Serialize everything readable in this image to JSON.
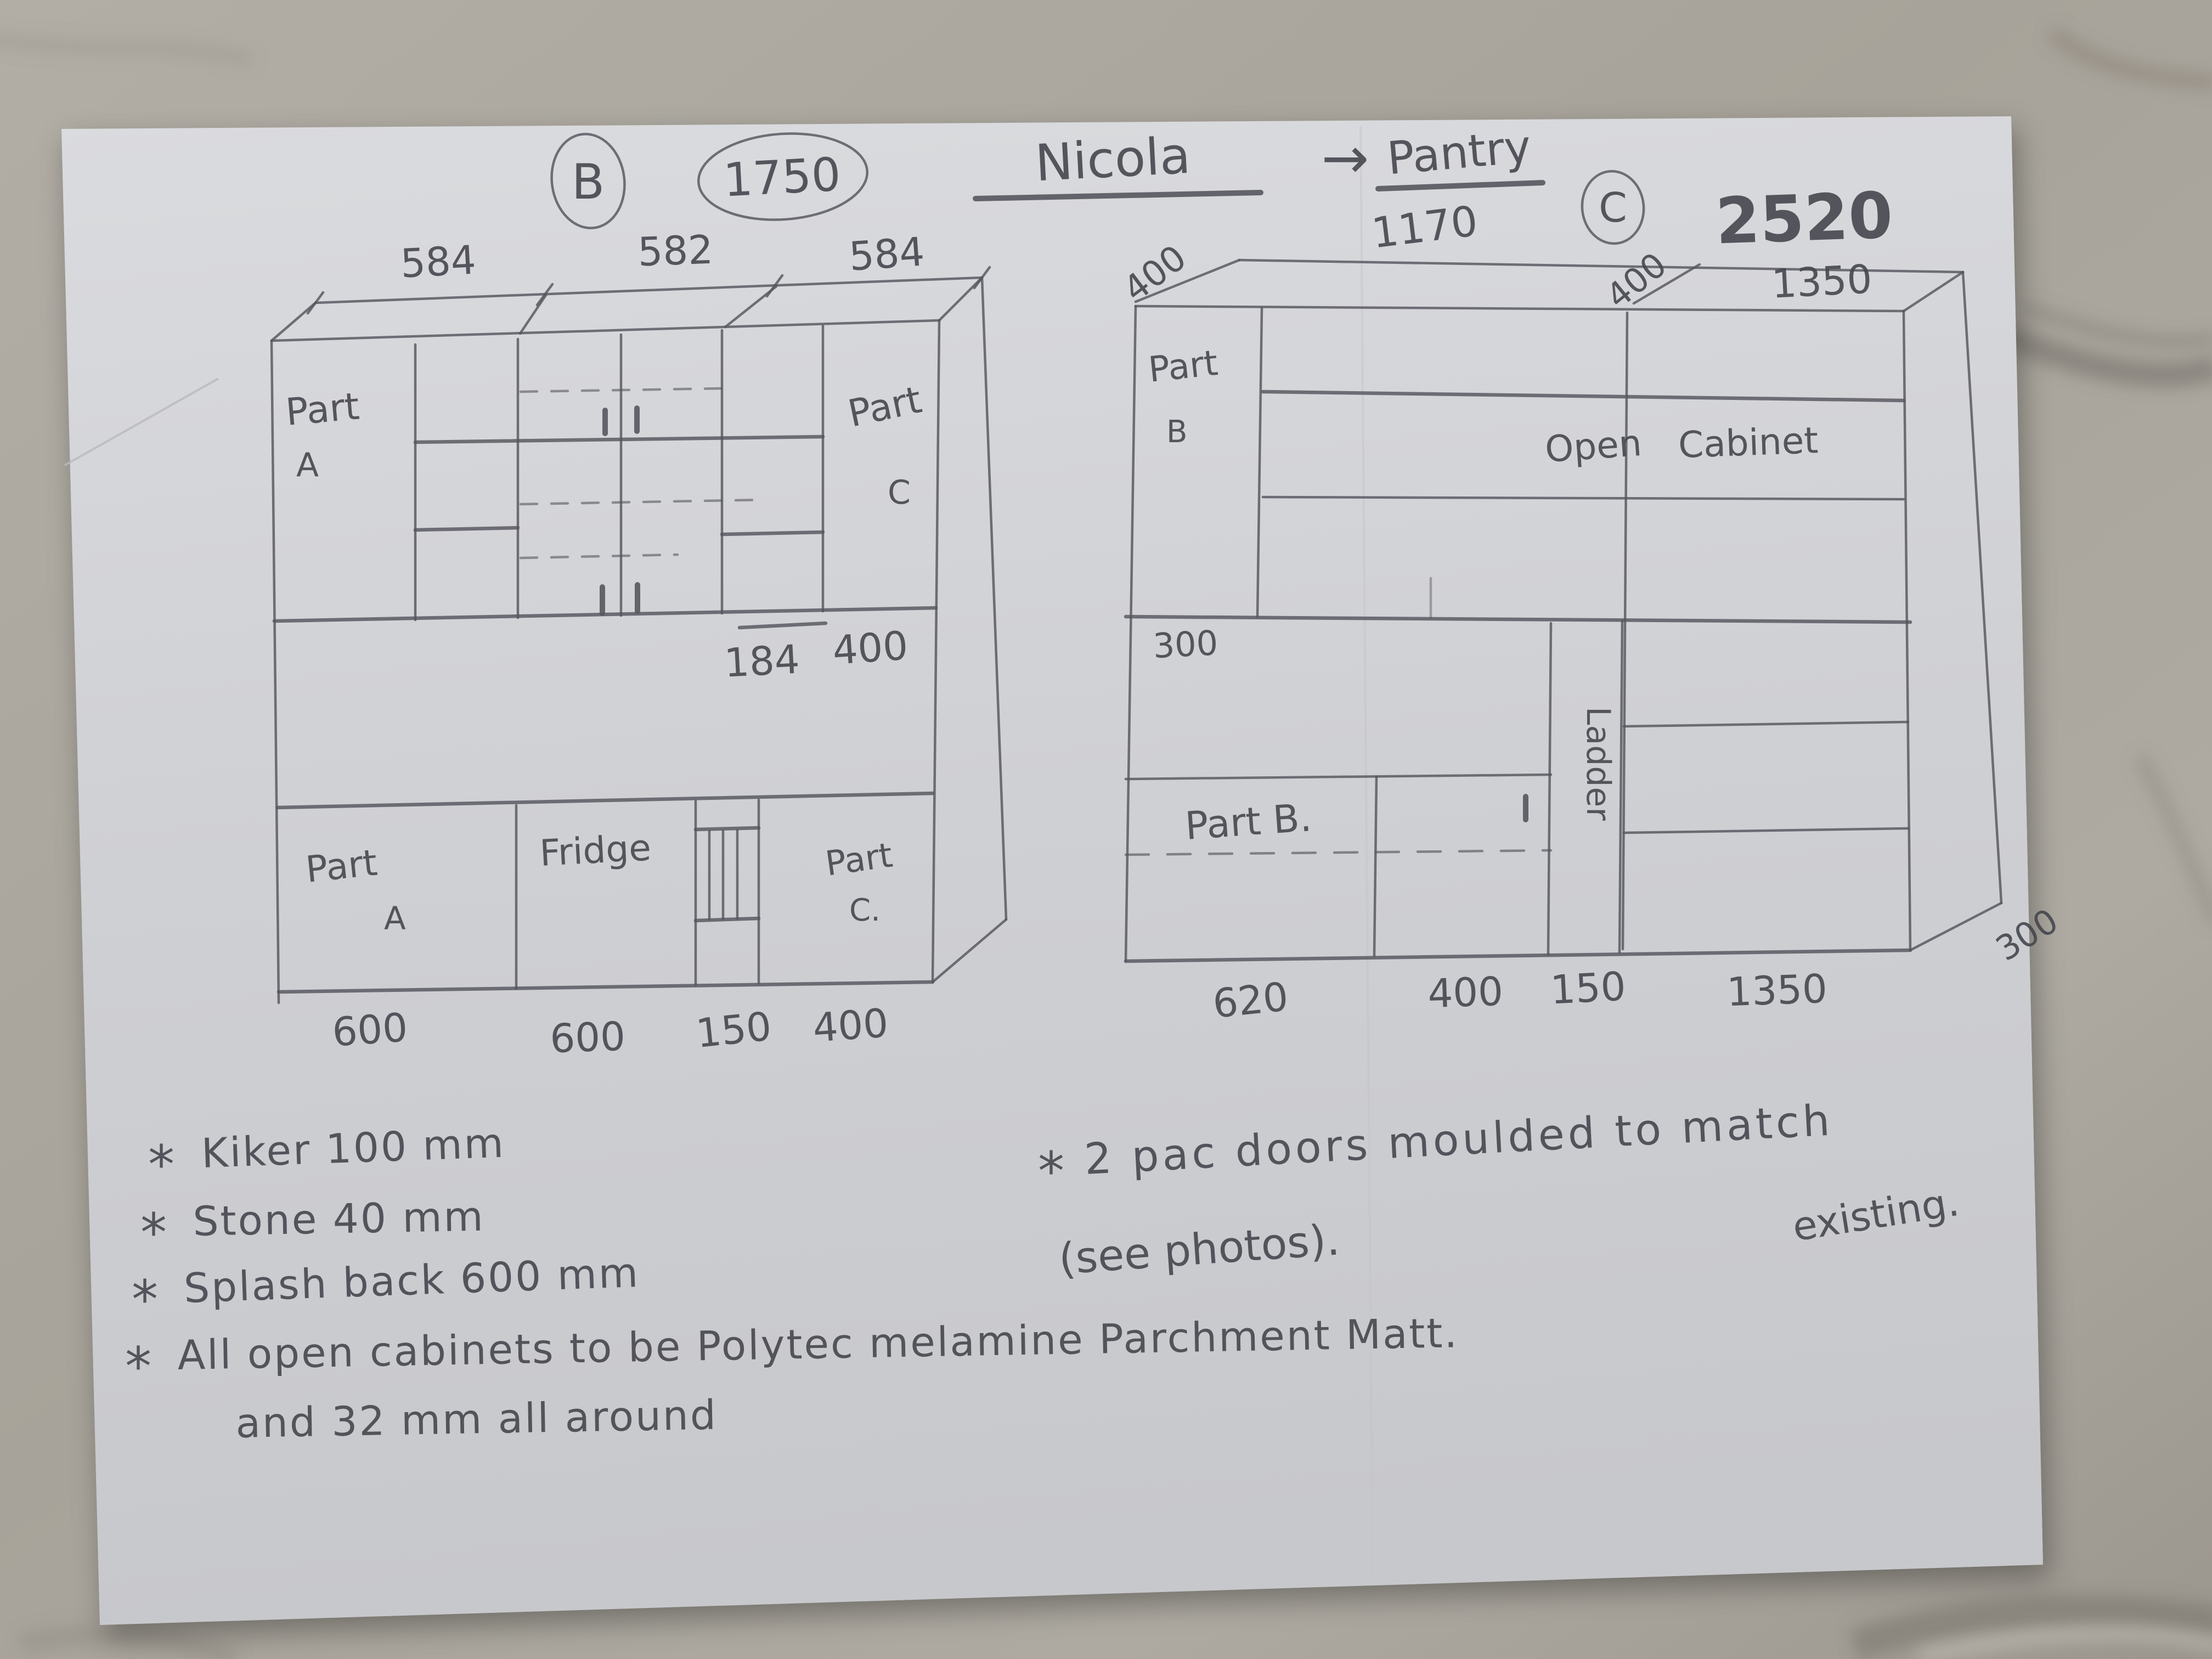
{
  "palette": {
    "marble": "#a9a49c",
    "paper": "#d4d5d9",
    "pencil": "#50505a"
  },
  "header": {
    "sheet_b_circle": "B",
    "sheet_b_total": "1750",
    "client": "Nicola",
    "arrow": "→",
    "room": "Pantry",
    "sheet_c_circle": "C",
    "c_total": "2520"
  },
  "cabinet_b": {
    "top_dims": [
      "584",
      "582",
      "584"
    ],
    "part_upper_left": {
      "l1": "Part",
      "l2": "A"
    },
    "part_upper_right": {
      "l1": "Part",
      "l2": "C"
    },
    "step_dims": [
      "184",
      "400"
    ],
    "base_left": {
      "l1": "Part",
      "l2": "A"
    },
    "fridge": "Fridge",
    "base_right": {
      "l1": "Part",
      "l2": "C."
    },
    "base_dims": [
      "600",
      "600",
      "150",
      "400"
    ]
  },
  "pantry_c": {
    "top_width_left": "1170",
    "depth_top_left": "400",
    "depth_mid": "400",
    "top_width_right": "1350",
    "part_b": {
      "l1": "Part",
      "l2": "B"
    },
    "open_cabinet": {
      "l1": "Open",
      "l2": "Cabinet"
    },
    "bench_height": "300",
    "ladder": "Ladder",
    "part_b_lower": "Part B.",
    "base_dims": [
      "620",
      "400",
      "150",
      "1350"
    ],
    "side_depth": "300"
  },
  "notes_left": {
    "bullet": "*",
    "l1": "Kiker 100 mm",
    "l2": "Stone 40 mm",
    "l3": "Splash back 600 mm",
    "l4": "All open cabinets to be Polytec melamine Parchment Matt.",
    "l5": "and 32 mm all around"
  },
  "notes_right": {
    "bullet": "*",
    "l1": "2 pac doors moulded to match",
    "l1b": "existing.",
    "l2": "(see photos)."
  }
}
